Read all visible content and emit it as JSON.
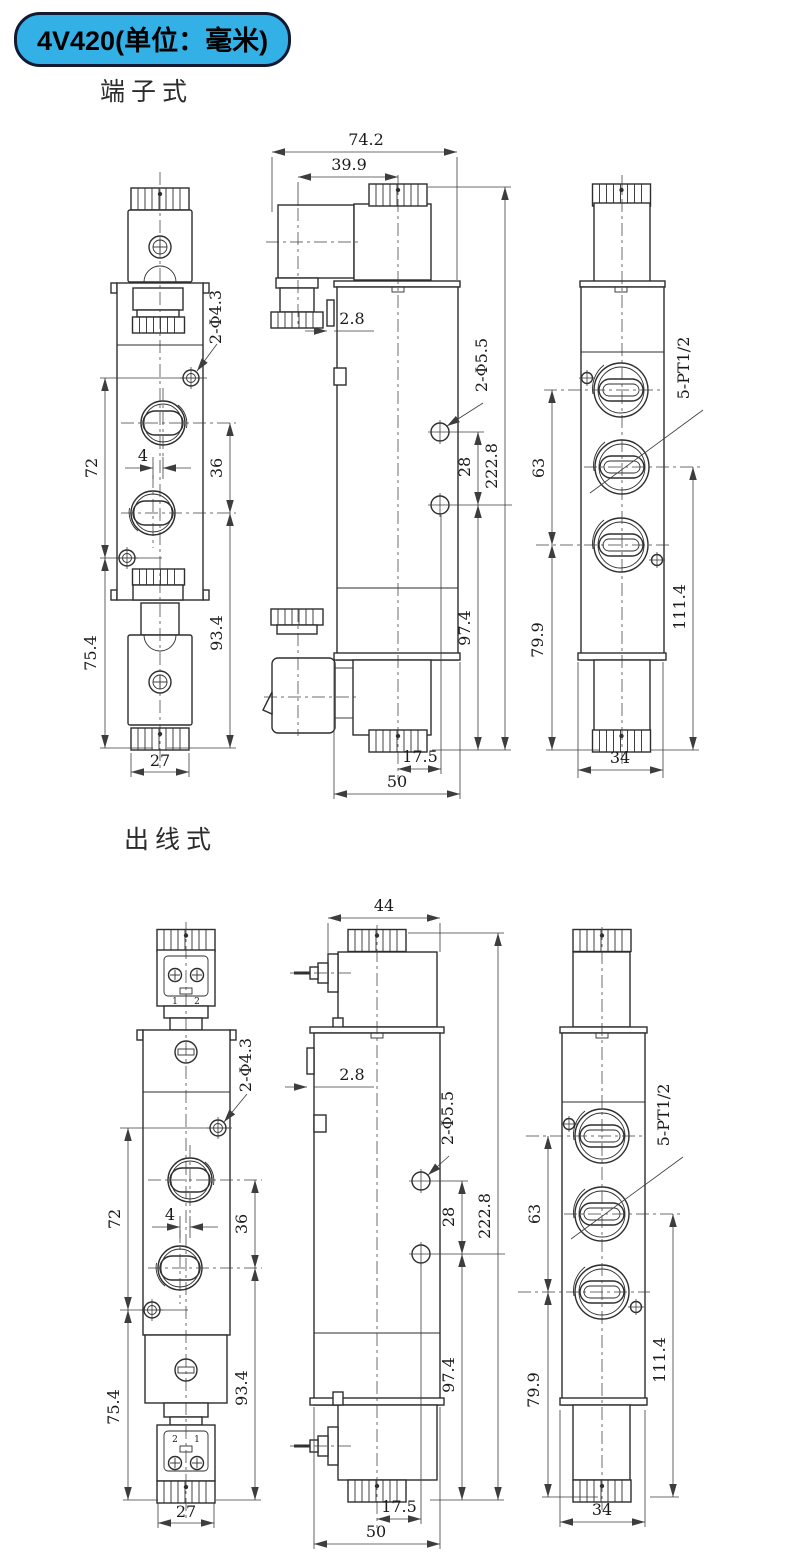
{
  "badge": {
    "label": "4V420(单位：毫米)"
  },
  "colors": {
    "badge_bg": "#33b1e6",
    "badge_border": "#101b33",
    "line": "#2e2e2e"
  },
  "sections": [
    {
      "title": "端子式",
      "front": {
        "d72": "72",
        "d75_4": "75.4",
        "d4": "4",
        "d36": "36",
        "d93_4": "93.4",
        "d27": "27",
        "hole_label": "2-Φ4.3"
      },
      "side": {
        "d74_2": "74.2",
        "d39_9": "39.9",
        "d2_8": "2.8",
        "hole_label": "2-Φ5.5",
        "d28": "28",
        "d222_8": "222.8",
        "d97_4": "97.4",
        "d17_5": "17.5",
        "d50": "50"
      },
      "end": {
        "d63": "63",
        "d79_9": "79.9",
        "port_label": "5-PT1/2",
        "d111_4": "111.4",
        "d34": "34"
      }
    },
    {
      "title": "出线式",
      "front": {
        "d72": "72",
        "d75_4": "75.4",
        "d4": "4",
        "d36": "36",
        "d93_4": "93.4",
        "d27": "27",
        "hole_label": "2-Φ4.3",
        "terminal_top": [
          "1",
          "2"
        ],
        "terminal_bottom": [
          "2",
          "1"
        ]
      },
      "side": {
        "d44": "44",
        "d2_8": "2.8",
        "hole_label": "2-Φ5.5",
        "d28": "28",
        "d222_8": "222.8",
        "d97_4": "97.4",
        "d17_5": "17.5",
        "d50": "50"
      },
      "end": {
        "d63": "63",
        "d79_9": "79.9",
        "port_label": "5-PT1/2",
        "d111_4": "111.4",
        "d34": "34"
      }
    }
  ]
}
